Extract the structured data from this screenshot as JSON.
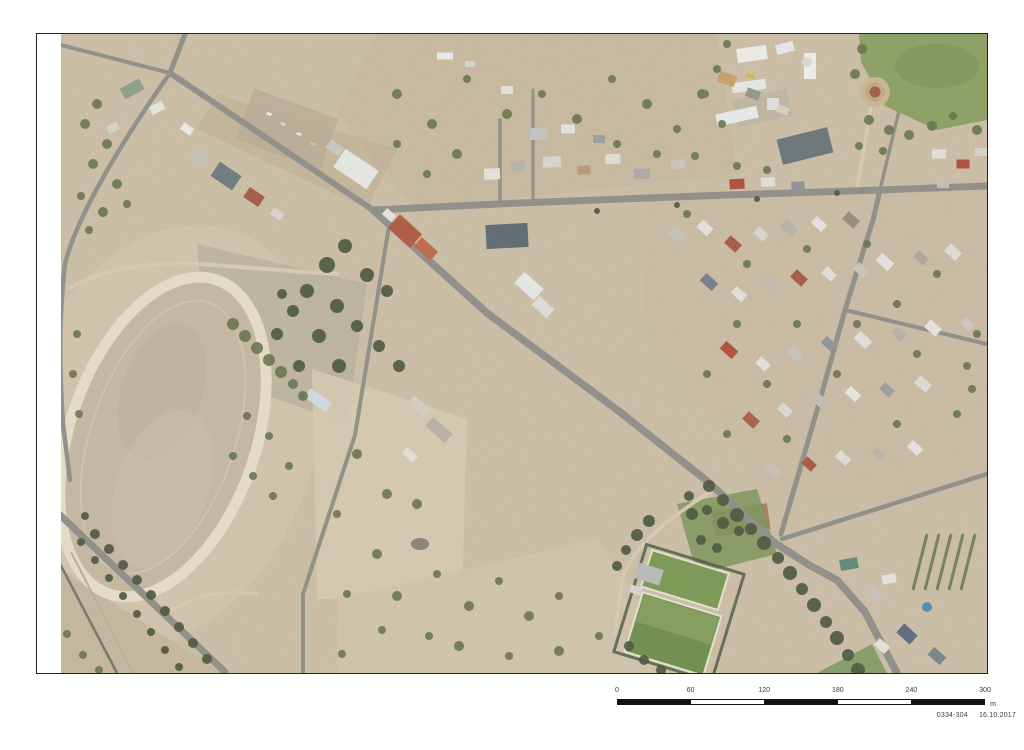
{
  "sheet": {
    "scale_bar": {
      "ticks": [
        "0",
        "60",
        "120",
        "180",
        "240",
        "300"
      ],
      "unit": "m"
    },
    "credit": {
      "ref": "0334-304",
      "date": "16.10.2017"
    }
  },
  "colors": {
    "ground": "#cec0a8",
    "ground_light": "#dcd2bc",
    "road": "#8f9089",
    "dirt_road": "#d9cdb4",
    "track_ring": "#e9e0ca",
    "track_infield": "#c7baa4",
    "tree_olive": "#64714a",
    "tree_dark": "#4a563b",
    "grass": "#8ca162",
    "green_field": "#7a9a52",
    "rail": "#76756d",
    "water": "#4f8fb0"
  }
}
